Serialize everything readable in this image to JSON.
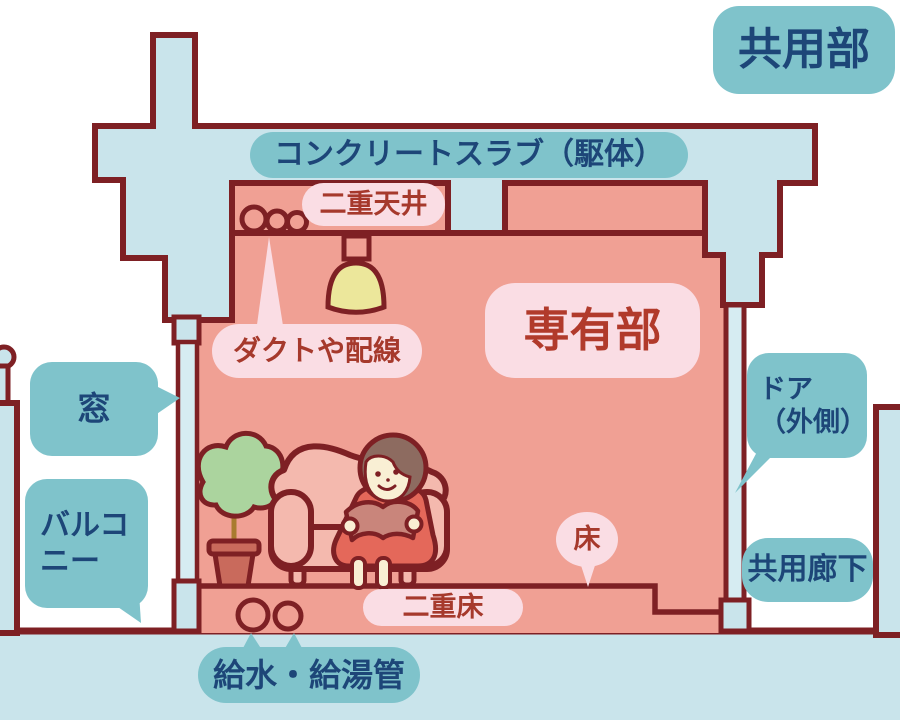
{
  "diagram": {
    "description": "マンション断面図：共用部と専有部",
    "labels": {
      "common_area": "共用部",
      "concrete_slab": "コンクリートスラブ（駆体）",
      "double_ceiling": "二重天井",
      "ducts_wiring": "ダクトや配線",
      "private_area": "専有部",
      "window": "窓",
      "balcony": "バルコニー",
      "door_outside": "ドア\n（外側）",
      "common_corridor": "共用廊下",
      "floor": "床",
      "double_floor": "二重床",
      "water_supply_pipes": "給水・給湯管"
    },
    "colors": {
      "outline_maroon": "#7e2024",
      "concrete_blue": "#c9e4eb",
      "room_salmon": "#f0a094",
      "teal_label_bg": "#7fc3cb",
      "teal_label_text": "#1d4678",
      "pink_label_bg": "#fadde4",
      "pink_label_text": "#a6392c",
      "private_label_text": "#b13a2b",
      "lamp_yellow": "#ece79b",
      "plant_green": "#abd49e",
      "sofa_pink": "#f4b9ae",
      "dress_red": "#e4685a",
      "background": "#ffffff"
    }
  }
}
